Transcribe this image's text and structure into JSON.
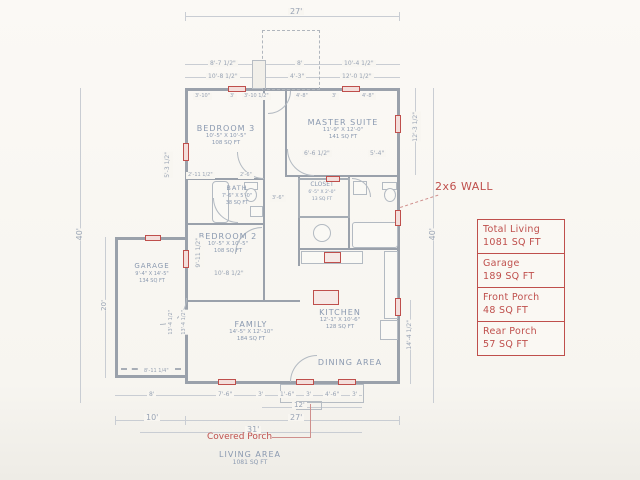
{
  "drawing": {
    "living_area_title": "LIVING AREA",
    "living_area_value": "1081 SQ FT",
    "covered_porch_label": "Covered Porch",
    "wall_note": "2x6 WALL"
  },
  "legend": {
    "items": [
      {
        "label": "Total Living",
        "value": "1081 SQ FT"
      },
      {
        "label": "Garage",
        "value": "189 SQ FT"
      },
      {
        "label": "Front Porch",
        "value": "48 SQ FT"
      },
      {
        "label": "Rear Porch",
        "value": "57 SQ FT"
      }
    ]
  },
  "rooms": {
    "bedroom3": {
      "name": "BEDROOM 3",
      "dims": "10'-5\" X 10'-5\"",
      "area": "108 SQ FT"
    },
    "bath": {
      "name": "BATH",
      "dims": "7'-6\" X 5'-0\"",
      "area": "38 SQ FT"
    },
    "bedroom2": {
      "name": "BEDROOM 2",
      "dims": "10'-5\" X 10'-5\"",
      "area": "108 SQ FT"
    },
    "master_suite": {
      "name": "MASTER SUITE",
      "dims": "11'-9\" X 12'-0\"",
      "area": "141 SQ FT"
    },
    "closet": {
      "name": "CLOSET",
      "dims": "6'-5\" X 2'-0\"",
      "area": "13 SQ FT"
    },
    "garage": {
      "name": "GARAGE",
      "dims": "9'-4\" X 14'-5\"",
      "area": "134 SQ FT"
    },
    "family": {
      "name": "FAMILY",
      "dims": "14'-5\" X 12'-10\"",
      "area": "184 SQ FT"
    },
    "kitchen": {
      "name": "KITCHEN",
      "dims": "12'-1\" X 10'-6\"",
      "area": "128 SQ FT"
    },
    "dining": {
      "name": "DINING AREA"
    }
  },
  "dimensions": {
    "top_overall": "27'",
    "top_row2": [
      "8'-7 1/2\"",
      "8'",
      "10'-4 1/2\""
    ],
    "top_row3": [
      "10'-8 1/2\"",
      "4'-3\"",
      "12'-0 1/2\""
    ],
    "bed3_top_row": [
      "3'-10\"",
      "3'",
      "3'-10 1/2\""
    ],
    "master_top_row": [
      "4'-8\"",
      "3'",
      "4'-8\""
    ],
    "left_upper": "5'-3 1/2\"",
    "left_overall": "40'",
    "left_garage": "20'",
    "garage_bottom": "8'-11 1/4\"",
    "garage_inner_a": "13'-4 1/2\"",
    "garage_inner_b": "13'-4 1/2\"",
    "right_upper": "12'-3 1/2\"",
    "right_overall": "40'",
    "right_lower": "14'-4 1/2\"",
    "bedroom2_left": "9'-11 1/2\"",
    "bedroom2_bottom": "10'-8 1/2\"",
    "master_bottom_left": "6'-6 1/2\"",
    "master_bottom_right": "5'-4\"",
    "bath_top": "2'-6\"",
    "hall_width": "3'-6\"",
    "bed3_left_lower": "2'-11 1/2\"",
    "bottom_row1": [
      "8'",
      "7'-6\"",
      "3'",
      "1'-6\"",
      "3'",
      "4'-6\"",
      "3'"
    ],
    "bottom_row2": "12'",
    "bottom_row3_left": "10'",
    "bottom_row3_right": "27'",
    "bottom_row4": "31'"
  },
  "colors": {
    "ink": "#8a99b0",
    "wall": "#9aa1ab",
    "accent_red": "#bf4f4c",
    "paper": "#f7f5f0"
  }
}
